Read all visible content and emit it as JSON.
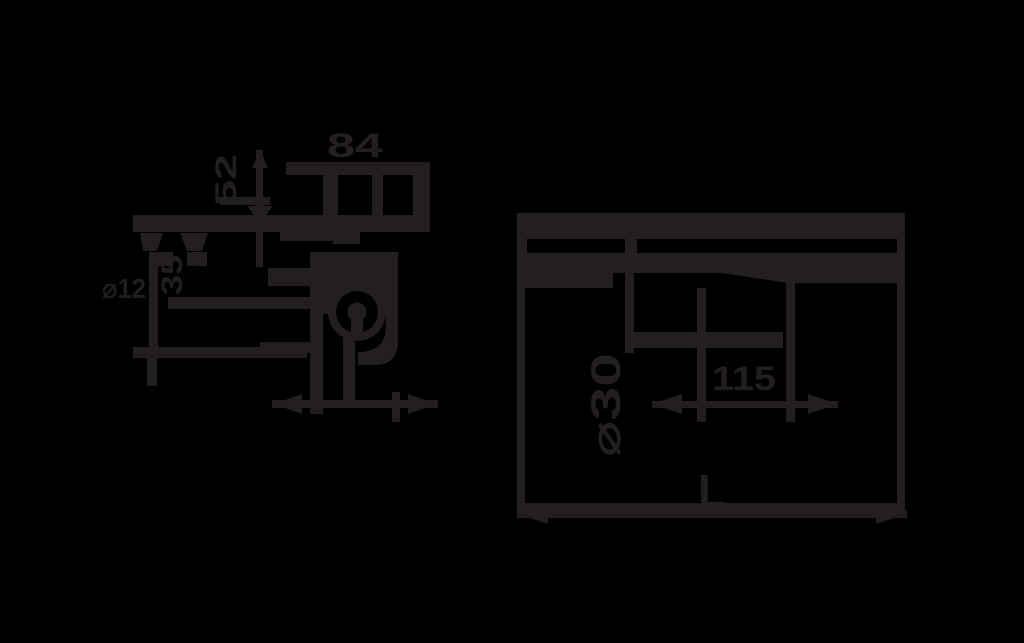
{
  "drawing": {
    "title": "technical dimension drawing, two views",
    "ink_color": "#231F20",
    "background_color": "#000000",
    "left_view": {
      "top_width_label": "84",
      "stem_height_label": "52",
      "wall_height_label": "35",
      "edge_diameter_label": "⌀12"
    },
    "right_view": {
      "spacing_label": "115",
      "diameter_label": "⌀30",
      "length_label": "L"
    }
  }
}
